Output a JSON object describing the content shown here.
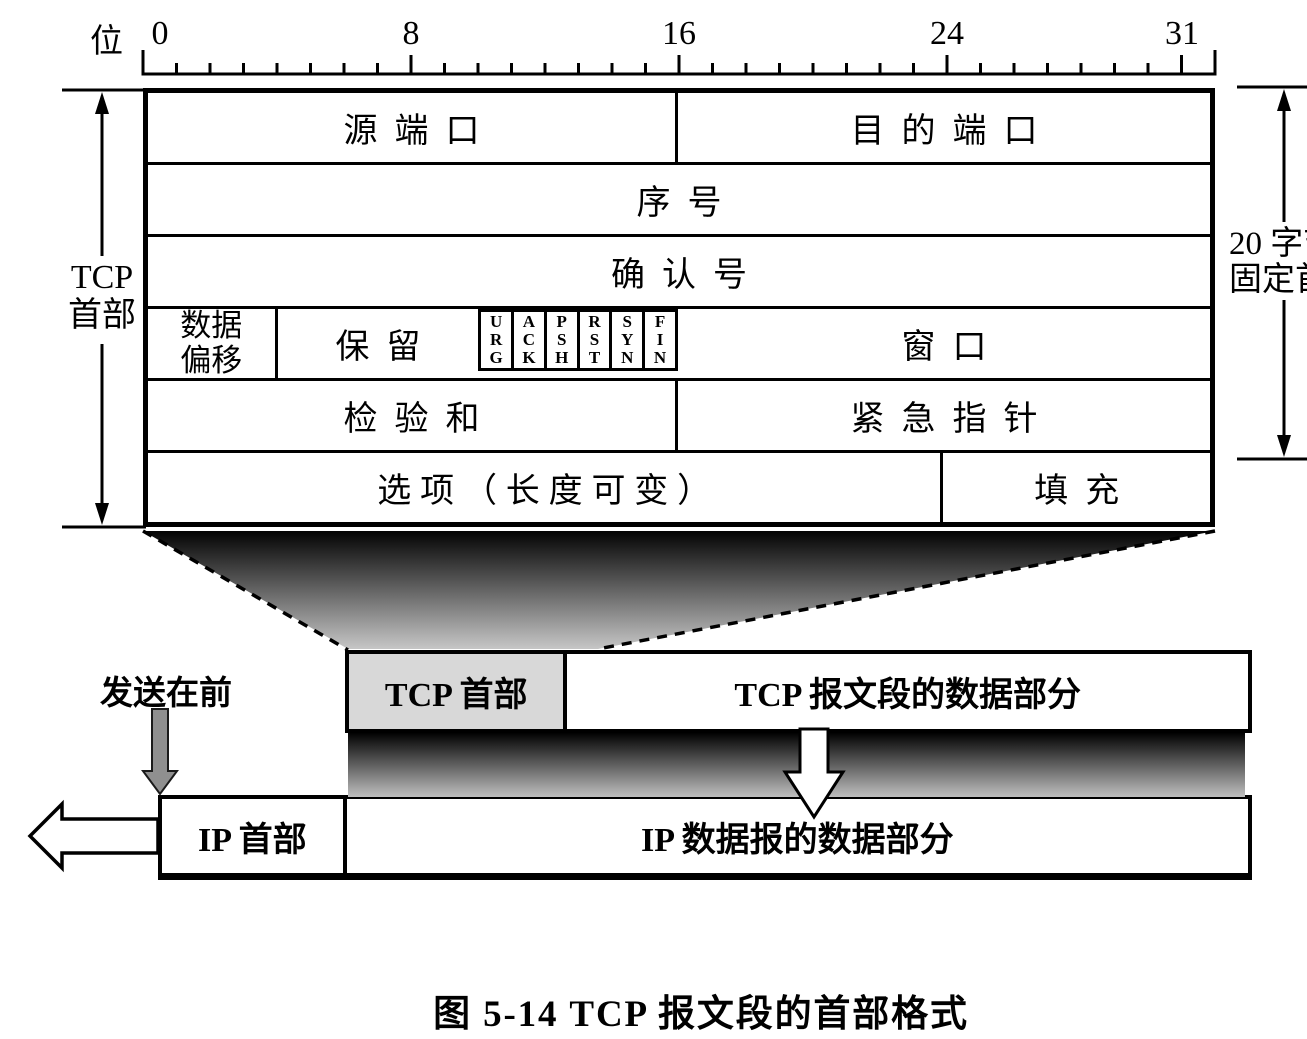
{
  "colors": {
    "ink": "#000000",
    "background": "#ffffff",
    "tcp_header_cell_fill": "#d8d8d8",
    "send_arrow_gray": "#8f8f8f",
    "shadow_dark": "#030303",
    "shadow_light": "#c6c6c6"
  },
  "ruler": {
    "axis_label": "位",
    "bits_total": 32,
    "tick_labels": [
      "0",
      "8",
      "16",
      "24",
      "31"
    ]
  },
  "tcp_header_bracket": {
    "label": "TCP\n首部"
  },
  "fixed_header_bracket": {
    "label": "20 字节\n固定首部"
  },
  "header_table": {
    "row1": {
      "source_port": "源端口",
      "dest_port": "目的端口"
    },
    "row2": {
      "seq": "序号"
    },
    "row3": {
      "ack": "确认号"
    },
    "row4": {
      "data_offset": "数据\n偏移",
      "reserved": "保留",
      "flags": [
        "U\nR\nG",
        "A\nC\nK",
        "P\nS\nH",
        "R\nS\nT",
        "S\nY\nN",
        "F\nI\nN"
      ],
      "window": "窗口"
    },
    "row5": {
      "checksum": "检验和",
      "urgent_pointer": "紧急指针"
    },
    "row6": {
      "options": "选项（长度可变）",
      "padding": "填充"
    }
  },
  "segment_row": {
    "tcp_header": "TCP 首部",
    "tcp_data": "TCP 报文段的数据部分"
  },
  "send_first_label": "发送在前",
  "ip_row": {
    "ip_header": "IP 首部",
    "ip_data": "IP 数据报的数据部分"
  },
  "caption": "图 5-14  TCP 报文段的首部格式",
  "icons": {
    "tcp_header_extent": "double-vertical-arrow",
    "fixed_header_extent": "double-vertical-arrow",
    "send_first": "gray-down-arrow",
    "encapsulate": "hollow-down-arrow",
    "transmit": "hollow-left-arrow"
  }
}
